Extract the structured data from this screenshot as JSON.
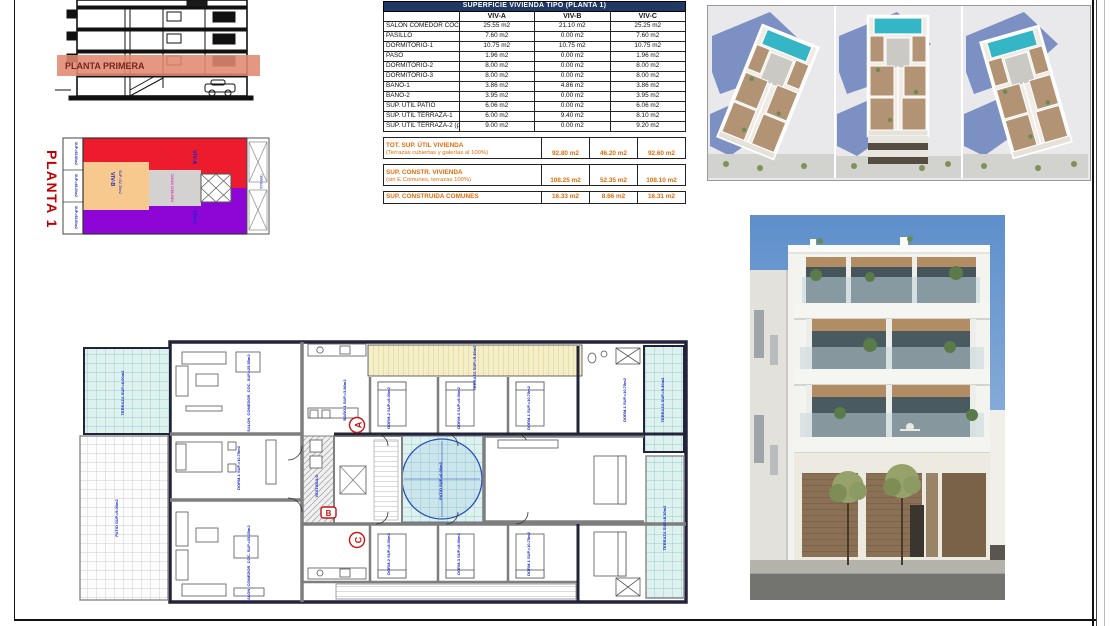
{
  "colors": {
    "header_navy": "#1F3864",
    "totals_orange": "#E36C0A",
    "viv_a_red": "#EC1B2E",
    "viv_b_orange": "#F8C98E",
    "viv_c_purple": "#8E06D6",
    "band_salmon": "#E18A70",
    "label_blue": "#1626C8"
  },
  "section": {
    "band_label": "PLANTA PRIMERA"
  },
  "key_plan": {
    "title": "PLANTA 1",
    "viv_a": "VIV-A",
    "viv_b": "VIV-B",
    "viv_b_sup": "SUP.=52.35m2",
    "viv_c": "VIV-C",
    "comunes": "ZONAS COMUNES",
    "terraza": "TERRAZA",
    "side_labels": [
      "SUP.=92.80m2",
      "SUP.=46.20m2",
      "SUP.=92.60m2"
    ]
  },
  "area_table": {
    "title": "SUPERFICIE VIVIENDA TIPO (PLANTA 1)",
    "columns": [
      "VIV-A",
      "VIV-B",
      "VIV-C"
    ],
    "rows": [
      {
        "label": "SALON COMEDOR COCINA",
        "a": "25.55 m2",
        "b": "21.10 m2",
        "c": "25.25 m2"
      },
      {
        "label": "PASILLO",
        "a": "7.60 m2",
        "b": "0.00 m2",
        "c": "7.60 m2"
      },
      {
        "label": "DORMITORIO-1",
        "a": "10.75 m2",
        "b": "10.75 m2",
        "c": "10.75 m2"
      },
      {
        "label": "PASO",
        "a": "1.96 m2",
        "b": "0.00 m2",
        "c": "1.96 m2"
      },
      {
        "label": "DORMITORIO-2",
        "a": "8.00 m2",
        "b": "0.00 m2",
        "c": "8.00 m2"
      },
      {
        "label": "DORMITORIO-3",
        "a": "8.00 m2",
        "b": "0.00 m2",
        "c": "8.00 m2"
      },
      {
        "label": "BAÑO-1",
        "a": "3.86 m2",
        "b": "4.86 m2",
        "c": "3.86 m2"
      },
      {
        "label": "BAÑO-2",
        "a": "3.95 m2",
        "b": "0.00 m2",
        "c": "3.95 m2"
      },
      {
        "label": "SUP. ÚTIL PATIO",
        "a": "6.06 m2",
        "b": "0.00 m2",
        "c": "6.06 m2"
      },
      {
        "label": "SUP. ÚTIL TERRAZA-1",
        "a": "6.00 m2",
        "b": "9.40 m2",
        "c": "8.10 m2"
      },
      {
        "label": "SUP. ÚTIL TERRAZA-2 (patio trasero)",
        "a": "9.00 m2",
        "b": "0.00 m2",
        "c": "9.20 m2"
      }
    ],
    "totals": [
      {
        "label": "TOT. SUP. ÚTIL VIVIENDA",
        "note": "(Terrazas cubiertas y galerías al 100%)",
        "a": "92.80 m2",
        "b": "46.20 m2",
        "c": "92.60 m2"
      },
      {
        "label": "SUP. CONSTR. VIVIENDA",
        "note": "(sin E.Comunes, terrazas 100%)",
        "a": "108.25 m2",
        "b": "52.35 m2",
        "c": "108.10 m2"
      },
      {
        "label": "SUP. CONSTRUIDA COMUNES",
        "note": "",
        "a": "16.33 m2",
        "b": "8.66 m2",
        "c": "16.31 m2"
      }
    ]
  },
  "plan": {
    "markers": {
      "a": "A",
      "b": "B",
      "c": "C"
    },
    "labels": {
      "terrace_tl": "TERRAZA SUP.=6.00m2",
      "patio_left": "PATIO SUP.=9.00m2",
      "salon_top": "SALON_COMEDOR_COC. SUP.=25.55m2",
      "dorm_left": "DORM-1 SUP.=10.75m2",
      "dorm_a1": "DORM-2 SUP.=8.00m2",
      "dorm_a2": "DORM-3 SUP.=8.00m2",
      "dorm_a3": "DORM-1 SUP.=10.75m2",
      "dorm_b": "DORM-1 SUP.=10.75m2",
      "bano1": "BAÑO-1 SUP.=3.86m2",
      "terrace_top": "TERRAZA SUP.=9.40m2",
      "patio_c": "PATIO SUP.=6.06m2",
      "terrace_r1": "TERRAZA SUP.=9.40m2",
      "terrace_r2": "TERRAZA SUP.=8.10m2",
      "salon_bot": "SALON_COMEDOR_COC. SUP.=25.25m2",
      "dorm_c1": "DORM-2 SUP.=8.00m2",
      "dorm_c2": "DORM-3 SUP.=8.00m2",
      "dorm_c3": "DORM-1 SUP.=10.75m2",
      "vestibulo": "VESTIBULO"
    }
  }
}
